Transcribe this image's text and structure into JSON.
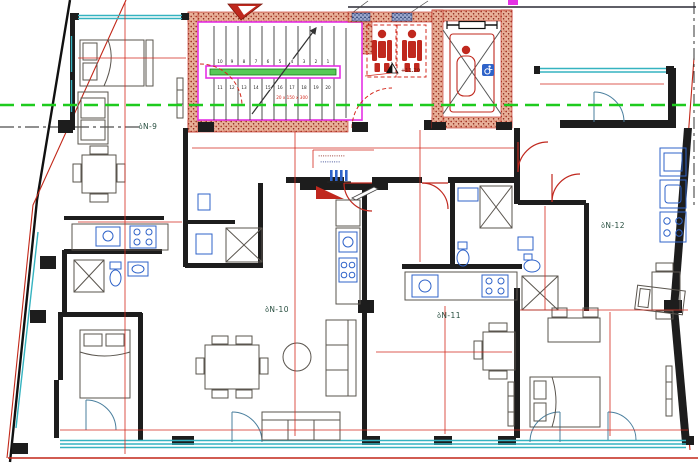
{
  "drawing": {
    "type": "architectural apartment floor plan",
    "level_mark": "+11.20",
    "apartments": {
      "a9": {
        "label": "ბN-9"
      },
      "a10": {
        "label": "ბN-10"
      },
      "a11": {
        "label": "ბN-11"
      },
      "a12": {
        "label": "ბN-12"
      }
    },
    "stairs": {
      "upper_flight": [
        "10",
        "9",
        "8",
        "7",
        "6",
        "5",
        "4",
        "3",
        "2",
        "1"
      ],
      "lower_flight": [
        "11",
        "12",
        "13",
        "14",
        "15",
        "16",
        "17",
        "18",
        "19",
        "20"
      ],
      "dimension_note": "20 x 150 x 300"
    },
    "panel_annotation": {
      "line1": "∙∙∙∙∙∙∙∙∙∙∙∙",
      "line2": "∙∙∙∙∙∙∙∙∙"
    },
    "colors": {
      "wall_black": "#1d1d1d",
      "brick_hatch_red": "#b2402e",
      "core_outline_magenta": "#e431e4",
      "handrail_green": "#57c957",
      "section_line_green": "#1ecb1e",
      "dimension_red": "#d3281c",
      "window_cyan": "#35b3c0",
      "fixture_blue": "#2f63c9",
      "label_teal": "#274e3f"
    }
  }
}
